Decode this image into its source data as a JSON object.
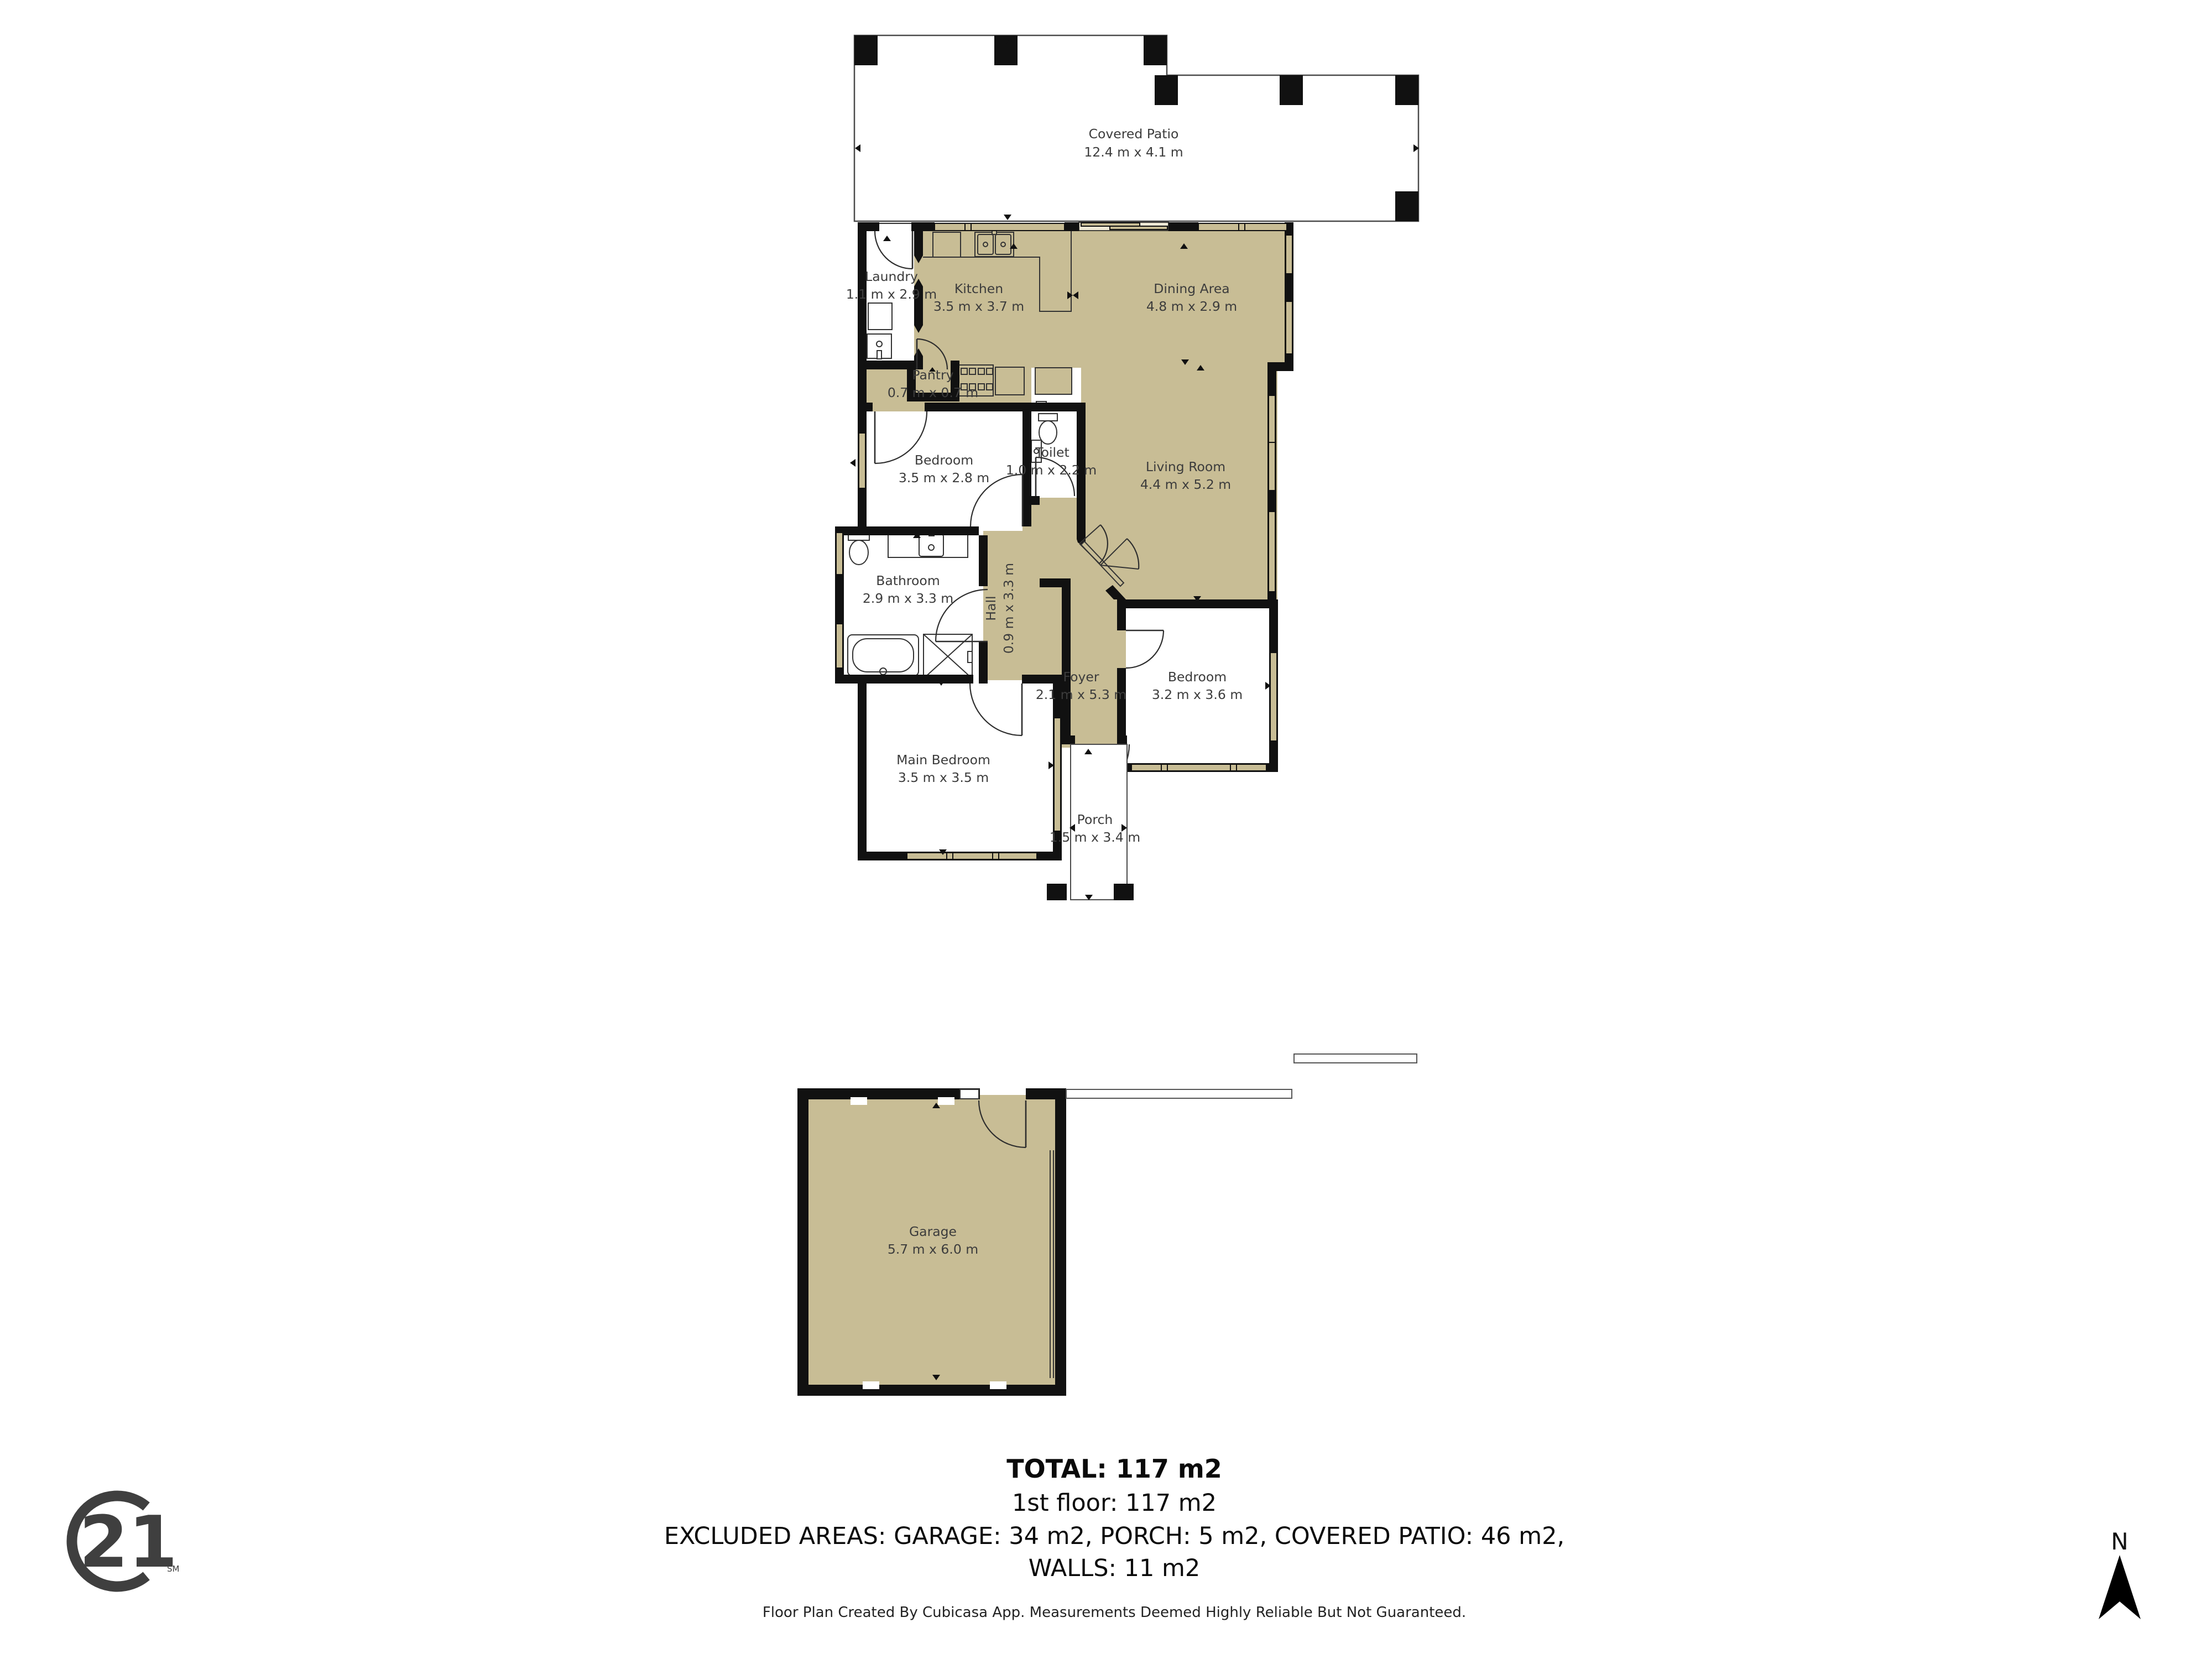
{
  "plan": {
    "rooms": [
      {
        "id": "covered-patio",
        "name": "Covered Patio",
        "dims": "12.4 m x 4.1 m"
      },
      {
        "id": "laundry",
        "name": "Laundry",
        "dims": "1.1 m x 2.9 m"
      },
      {
        "id": "kitchen",
        "name": "Kitchen",
        "dims": "3.5 m x 3.7 m"
      },
      {
        "id": "dining-area",
        "name": "Dining Area",
        "dims": "4.8 m x 2.9 m"
      },
      {
        "id": "pantry",
        "name": "Pantry",
        "dims": "0.7 m x 0.7 m"
      },
      {
        "id": "bedroom-1",
        "name": "Bedroom",
        "dims": "3.5 m x 2.8 m"
      },
      {
        "id": "toilet",
        "name": "Toilet",
        "dims": "1.0 m x 2.2 m"
      },
      {
        "id": "living-room",
        "name": "Living Room",
        "dims": "4.4 m x 5.2 m"
      },
      {
        "id": "bathroom",
        "name": "Bathroom",
        "dims": "2.9 m x 3.3 m"
      },
      {
        "id": "hall",
        "name": "Hall",
        "dims": "0.9 m x 3.3 m"
      },
      {
        "id": "foyer",
        "name": "Foyer",
        "dims": "2.1 m x 5.3 m"
      },
      {
        "id": "bedroom-2",
        "name": "Bedroom",
        "dims": "3.2 m x 3.6 m"
      },
      {
        "id": "main-bedroom",
        "name": "Main Bedroom",
        "dims": "3.5 m x 3.5 m"
      },
      {
        "id": "porch",
        "name": "Porch",
        "dims": "1.5 m x 3.4 m"
      },
      {
        "id": "garage",
        "name": "Garage",
        "dims": "5.7 m x 6.0 m"
      }
    ]
  },
  "summary": {
    "total": "TOTAL: 117 m2",
    "floor": "1st floor: 117 m2",
    "excluded": "EXCLUDED AREAS: GARAGE: 34 m2, PORCH: 5 m2, COVERED PATIO: 46 m2,",
    "walls": "WALLS: 11 m2",
    "disclaimer": "Floor Plan Created By Cubicasa App. Measurements Deemed Highly Reliable But Not Guaranteed."
  },
  "branding": {
    "logo_number": "21",
    "logo_mark": "SM"
  },
  "compass": {
    "north_label": "N"
  },
  "colors": {
    "floor": "#C8BD95",
    "wall": "#111111",
    "slider_backing": "#EFE9D5",
    "label": "#3C3C3C"
  }
}
